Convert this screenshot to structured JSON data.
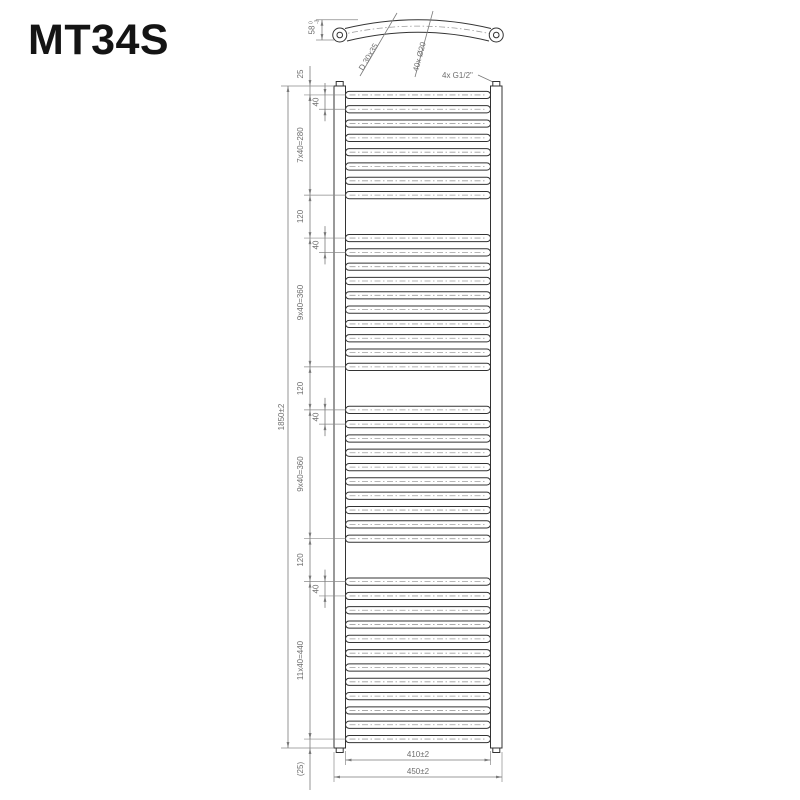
{
  "title": "MT34S",
  "colors": {
    "background": "#ffffff",
    "body_line": "#333333",
    "dimension_line": "#7a7a7a",
    "dimension_text": "#6e6e6e",
    "centerline": "#9e9e9e"
  },
  "top_view": {
    "bow_dim": {
      "value": "58",
      "tol_upper": "0",
      "tol_lower": "-3"
    },
    "profile_label": "D 30x35",
    "tube_label": "40x Ø20",
    "connection_label": "4x G1/2\""
  },
  "front_view": {
    "overall_height": "1850±2",
    "top_offset": "25",
    "top_offset_mm": 25,
    "bottom_offset": "(25)",
    "bottom_offset_mm": 25,
    "rung_pitch": "40",
    "pitch_mm": 40,
    "gap": "120",
    "gap_mm": 120,
    "groups": [
      {
        "count": 8,
        "label": "7x40=280"
      },
      {
        "count": 10,
        "label": "9x40=360"
      },
      {
        "count": 10,
        "label": "9x40=360"
      },
      {
        "count": 12,
        "label": "11x40=440"
      }
    ],
    "inner_width": "410±2",
    "outer_width": "450±2"
  }
}
